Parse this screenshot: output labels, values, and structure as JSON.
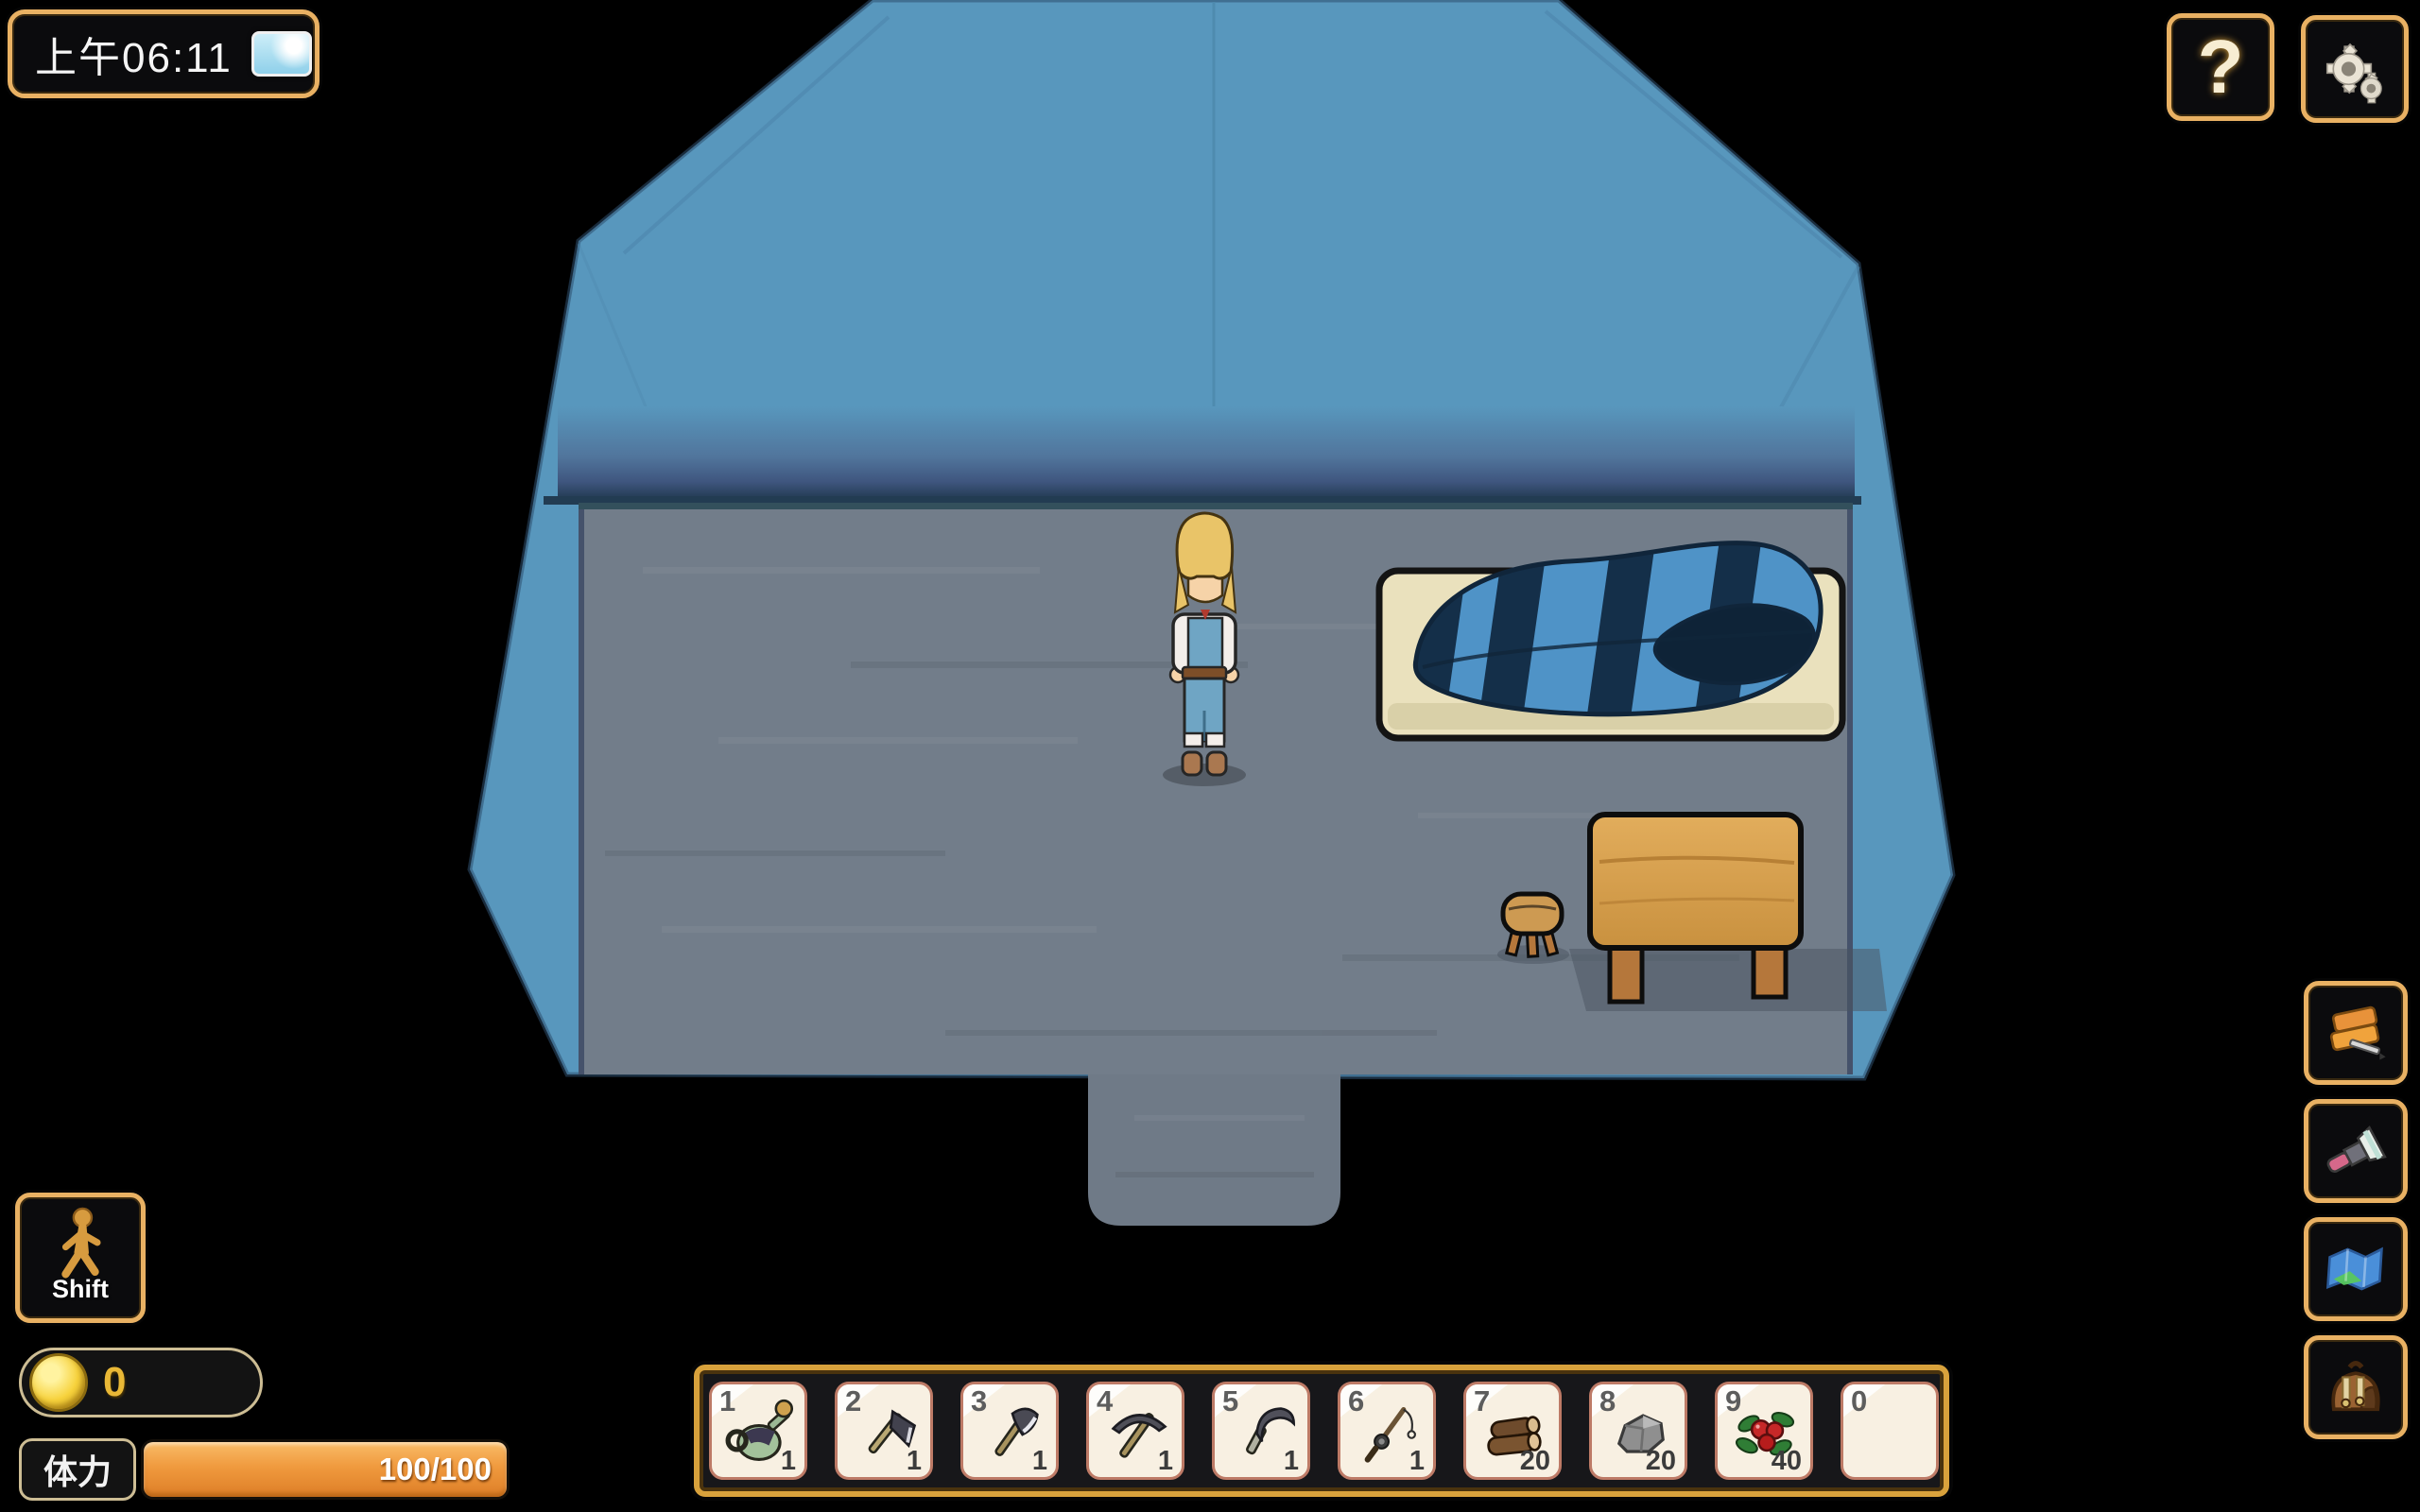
{
  "hud": {
    "time": {
      "label": "上午06:11",
      "weather_icon": "clear-sky-icon"
    },
    "help_label": "?",
    "shift_label": "Shift",
    "coins_value": "0",
    "stamina": {
      "label": "体力",
      "value": "100/100"
    }
  },
  "hotbar": {
    "slots": [
      {
        "num": "1",
        "item": "watering-can",
        "count": "1"
      },
      {
        "num": "2",
        "item": "hoe",
        "count": "1"
      },
      {
        "num": "3",
        "item": "axe",
        "count": "1"
      },
      {
        "num": "4",
        "item": "pickaxe",
        "count": "1"
      },
      {
        "num": "5",
        "item": "sickle",
        "count": "1"
      },
      {
        "num": "6",
        "item": "fishing-rod",
        "count": "1"
      },
      {
        "num": "7",
        "item": "wood-logs",
        "count": "20"
      },
      {
        "num": "8",
        "item": "stone",
        "count": "20"
      },
      {
        "num": "9",
        "item": "berries",
        "count": "40"
      },
      {
        "num": "0",
        "item": "",
        "count": ""
      }
    ]
  },
  "sidebar": {
    "buttons": [
      {
        "icon": "journal-icon"
      },
      {
        "icon": "flashlight-icon"
      },
      {
        "icon": "map-icon"
      },
      {
        "icon": "backpack-icon"
      }
    ]
  },
  "scene": {
    "objects": [
      "tent-interior",
      "wood-floor",
      "player-character",
      "sleeping-bag-bed",
      "wooden-table",
      "stool",
      "tent-entrance"
    ],
    "colors": {
      "tent_blue": "#5897bd",
      "floor_gray": "#727d8a",
      "mat_cream": "#eae1bd",
      "bag_blue": "#4f93c7",
      "bag_stripe": "#142f49",
      "wood": "#d9a456",
      "ui_gold": "#e9b163",
      "stamina_orange": "#f09a3e"
    }
  }
}
